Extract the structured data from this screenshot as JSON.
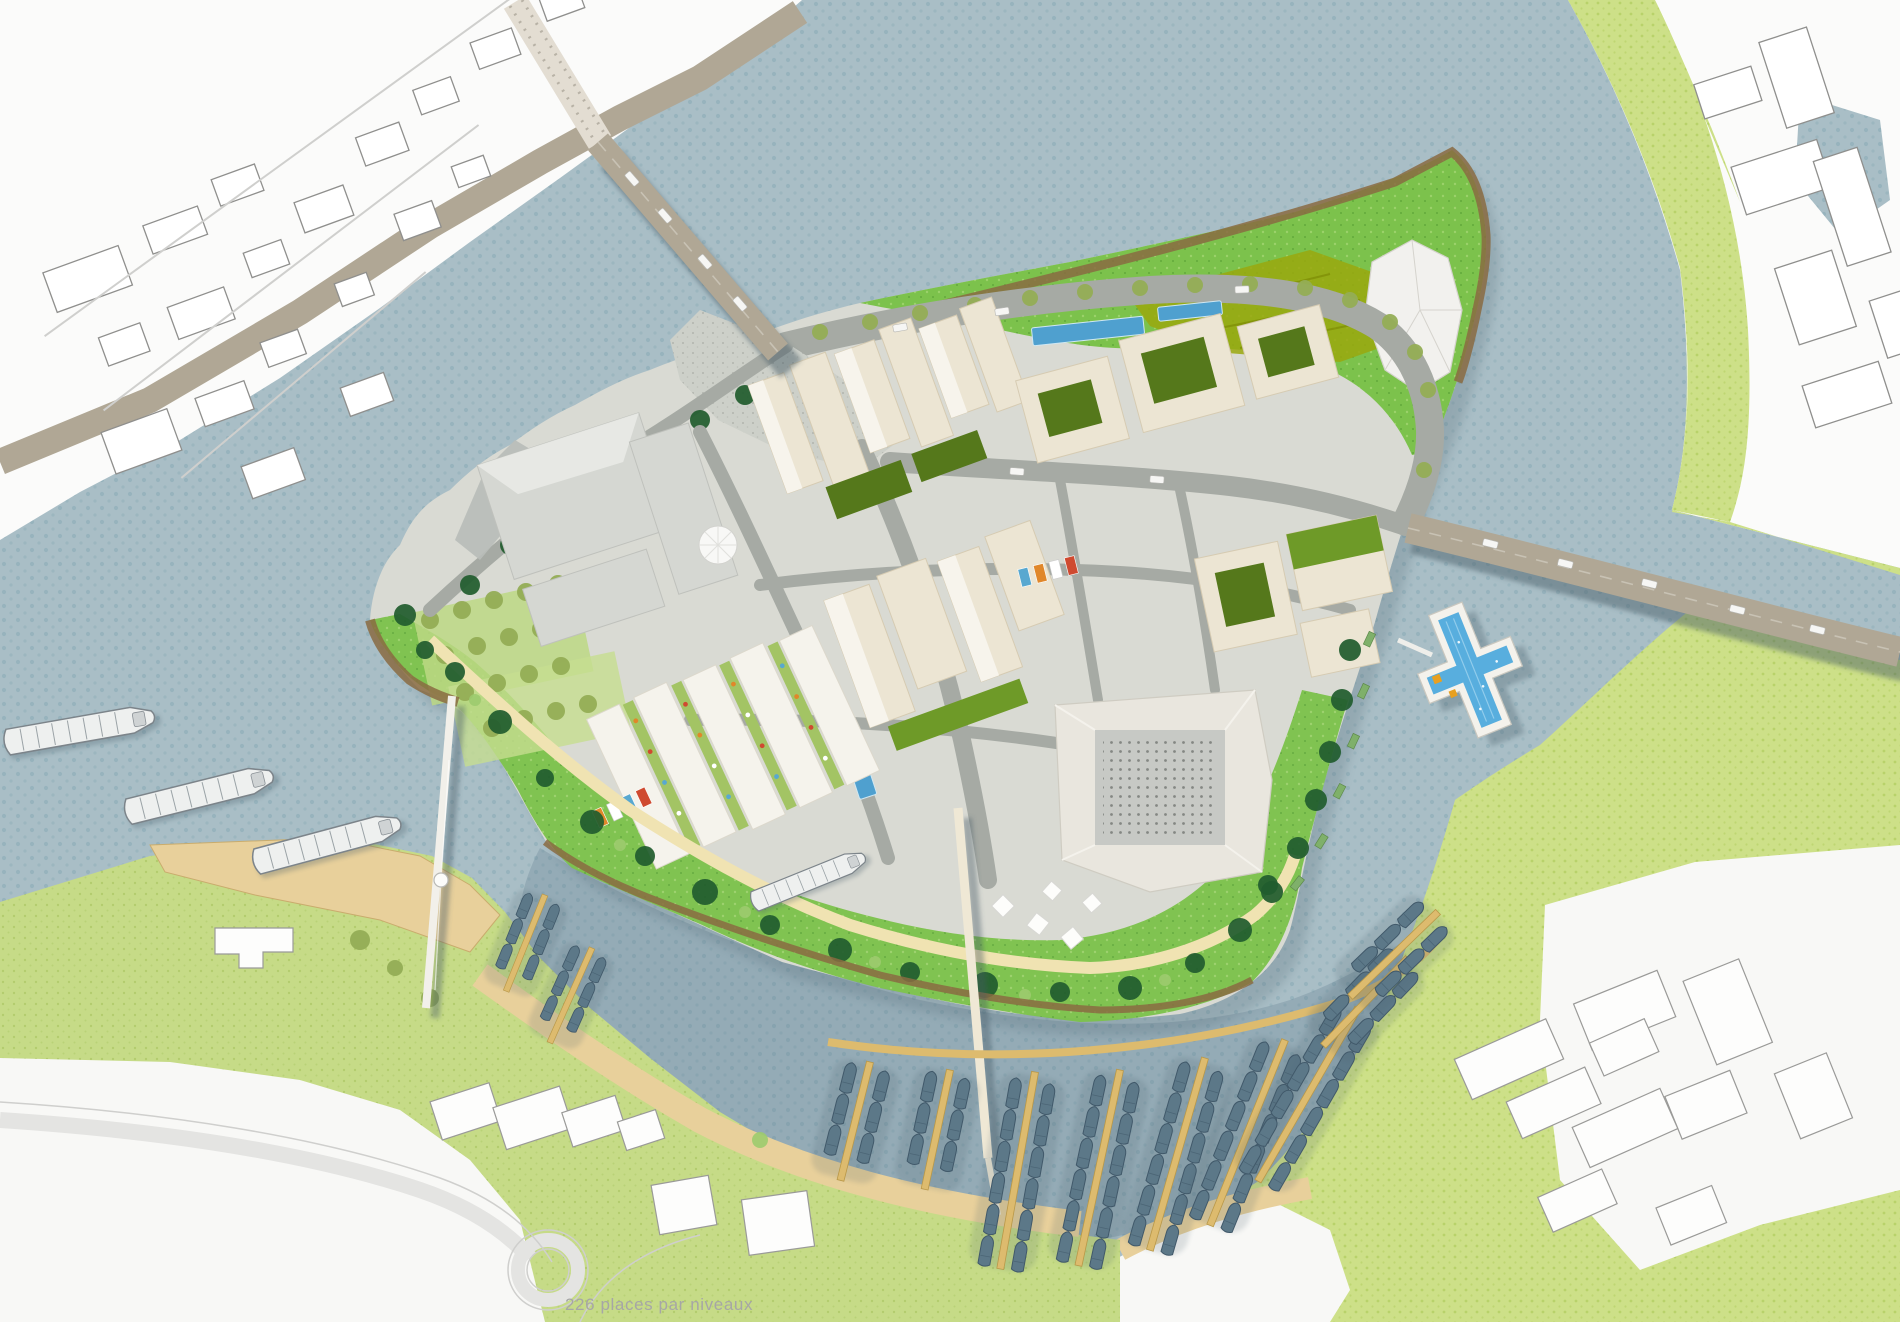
{
  "caption": {
    "text": "226 places par niveaux"
  },
  "palette": {
    "water": "#a9bec6",
    "waterDot": "#7ea4af",
    "marinaShade": "#5f7b8d",
    "contextWhite": "#fbfbfa",
    "contextLine": "#8f8f8d",
    "roadTaupe": "#b0a795",
    "bankGreen": "#cde088",
    "bankDot": "#a8c751",
    "lawnGreen": "#c6db87",
    "islandBase": "#d9dad3",
    "street": "#a6aaa4",
    "plaza": "#cdd0c9",
    "cream": "#ece5d3",
    "creamLine": "#d6cbb2",
    "bwhite": "#f5f3ec",
    "grayBox": "#d5d7d2",
    "court": "#55781b",
    "courtBright": "#6e9a28",
    "parkGreen": "#7cc24c",
    "parkOlive": "#9aa80e",
    "treeDark": "#215c2e",
    "treeOlive": "#93ad55",
    "boardwalk": "#8a6b42",
    "quayTan": "#e8d09b",
    "dockTan": "#ddbb6e",
    "poolBlue": "#58aede",
    "canalBlue": "#4fa0cf",
    "boatGray": "#5c7888",
    "shadow": "#4a5f6b",
    "captionCol": "#a6a6a6",
    "stallOrange": "#e0872a",
    "stallRed": "#cf4a30",
    "stallBlue": "#58a8d0"
  },
  "features": [
    {
      "id": "river"
    },
    {
      "id": "island"
    },
    {
      "id": "ne-park"
    },
    {
      "id": "monument"
    },
    {
      "id": "marina"
    },
    {
      "id": "cross-pool"
    },
    {
      "id": "nw-road-bridge"
    },
    {
      "id": "east-road-bridge"
    },
    {
      "id": "south-footbridge"
    },
    {
      "id": "west-cable-footbridge"
    },
    {
      "id": "barges"
    },
    {
      "id": "north-bank-city"
    },
    {
      "id": "east-bank-city"
    },
    {
      "id": "south-bank-city"
    }
  ]
}
